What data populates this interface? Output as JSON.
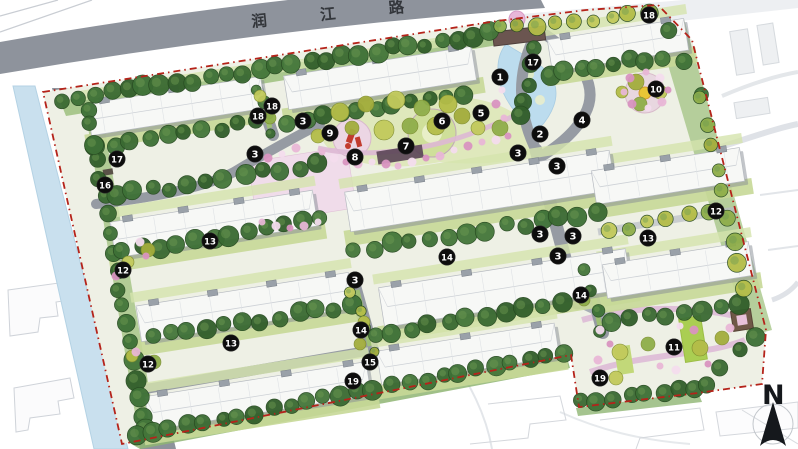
{
  "plan": {
    "road_label": "润 江 路",
    "north_label": "N"
  },
  "markers": [
    {
      "n": "1",
      "x": 500,
      "y": 77
    },
    {
      "n": "2",
      "x": 540,
      "y": 134
    },
    {
      "n": "3",
      "x": 303,
      "y": 121
    },
    {
      "n": "3",
      "x": 255,
      "y": 154
    },
    {
      "n": "3",
      "x": 518,
      "y": 153
    },
    {
      "n": "3",
      "x": 557,
      "y": 166
    },
    {
      "n": "3",
      "x": 540,
      "y": 234
    },
    {
      "n": "3",
      "x": 573,
      "y": 236
    },
    {
      "n": "3",
      "x": 558,
      "y": 256
    },
    {
      "n": "3",
      "x": 355,
      "y": 280
    },
    {
      "n": "4",
      "x": 582,
      "y": 120
    },
    {
      "n": "5",
      "x": 481,
      "y": 113
    },
    {
      "n": "6",
      "x": 442,
      "y": 121
    },
    {
      "n": "7",
      "x": 406,
      "y": 146
    },
    {
      "n": "8",
      "x": 355,
      "y": 157
    },
    {
      "n": "9",
      "x": 330,
      "y": 133
    },
    {
      "n": "10",
      "x": 656,
      "y": 89
    },
    {
      "n": "11",
      "x": 674,
      "y": 347
    },
    {
      "n": "12",
      "x": 716,
      "y": 211
    },
    {
      "n": "12",
      "x": 123,
      "y": 270
    },
    {
      "n": "12",
      "x": 148,
      "y": 364
    },
    {
      "n": "13",
      "x": 210,
      "y": 241
    },
    {
      "n": "13",
      "x": 648,
      "y": 238
    },
    {
      "n": "13",
      "x": 231,
      "y": 343
    },
    {
      "n": "14",
      "x": 447,
      "y": 257
    },
    {
      "n": "14",
      "x": 581,
      "y": 295
    },
    {
      "n": "14",
      "x": 361,
      "y": 330
    },
    {
      "n": "15",
      "x": 370,
      "y": 362
    },
    {
      "n": "16",
      "x": 105,
      "y": 185
    },
    {
      "n": "17",
      "x": 533,
      "y": 62
    },
    {
      "n": "17",
      "x": 117,
      "y": 159
    },
    {
      "n": "18",
      "x": 649,
      "y": 15
    },
    {
      "n": "18",
      "x": 272,
      "y": 106
    },
    {
      "n": "18",
      "x": 258,
      "y": 116
    },
    {
      "n": "19",
      "x": 353,
      "y": 381
    },
    {
      "n": "19",
      "x": 600,
      "y": 378
    }
  ],
  "colors": {
    "boundary_red": "#b5231a",
    "road_gray": "#8e939c",
    "inner_road_gray": "#969ba3",
    "canal_blue": "#c9e0ee",
    "water_blue": "#bcdcee",
    "tree_dark_green": "#3a6a32",
    "tree_yellow_green": "#b4bd48",
    "lawn_green": "#c6d897",
    "bright_lawn": "#aace52",
    "garden_pink": "#f0dcea",
    "shrub_pink": "#e8b6d6",
    "building_white": "#f7f8f6",
    "marker_black": "#0d0d0d",
    "pavilion_brown": "#6f5847",
    "sculpture_red": "#c23b2e"
  }
}
